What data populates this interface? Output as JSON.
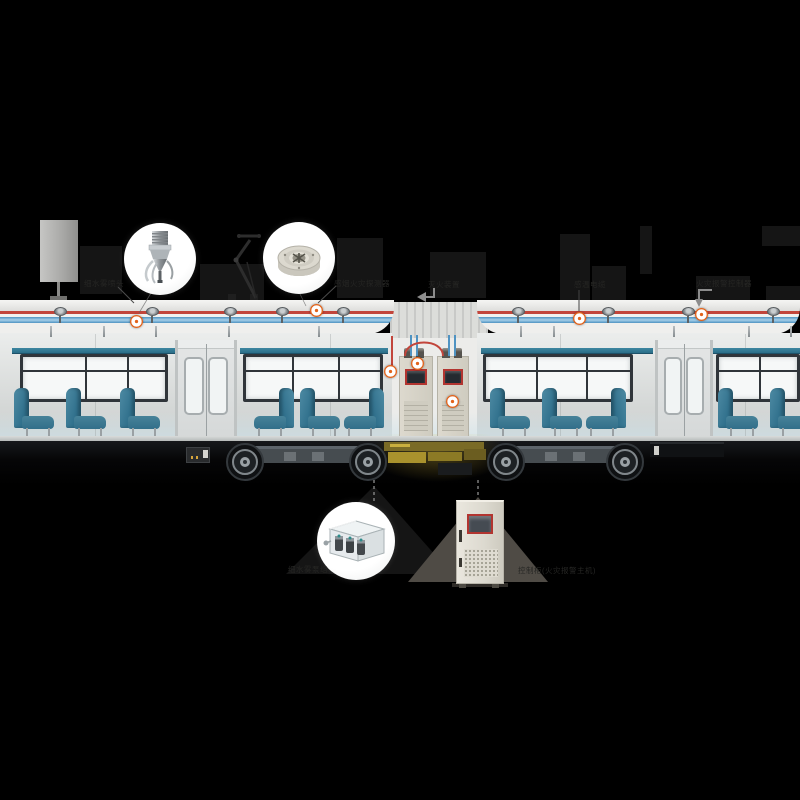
{
  "diagram": {
    "description": "metro train fire-protection system cutaway",
    "labels": {
      "mist_nozzle": "细水雾喷头",
      "smoke_detector": "感烟火灾探测器",
      "suppression_cabinet": "灭火装置",
      "heat_cable": "感温电缆",
      "alarm_controller": "火灾报警控制器",
      "pump_unit": "细水雾泵组",
      "control_cabinet": "控制柜(火灾报警主机)"
    },
    "colors": {
      "background": "#000000",
      "marker_orange": "#e2631b",
      "pipe_red": "#c2453b",
      "pipe_blue": "#4f93c2",
      "seat_teal": "#3c7d97",
      "accent_red_frame": "#b23530",
      "cabinet_body": "#dcd9cf"
    }
  }
}
